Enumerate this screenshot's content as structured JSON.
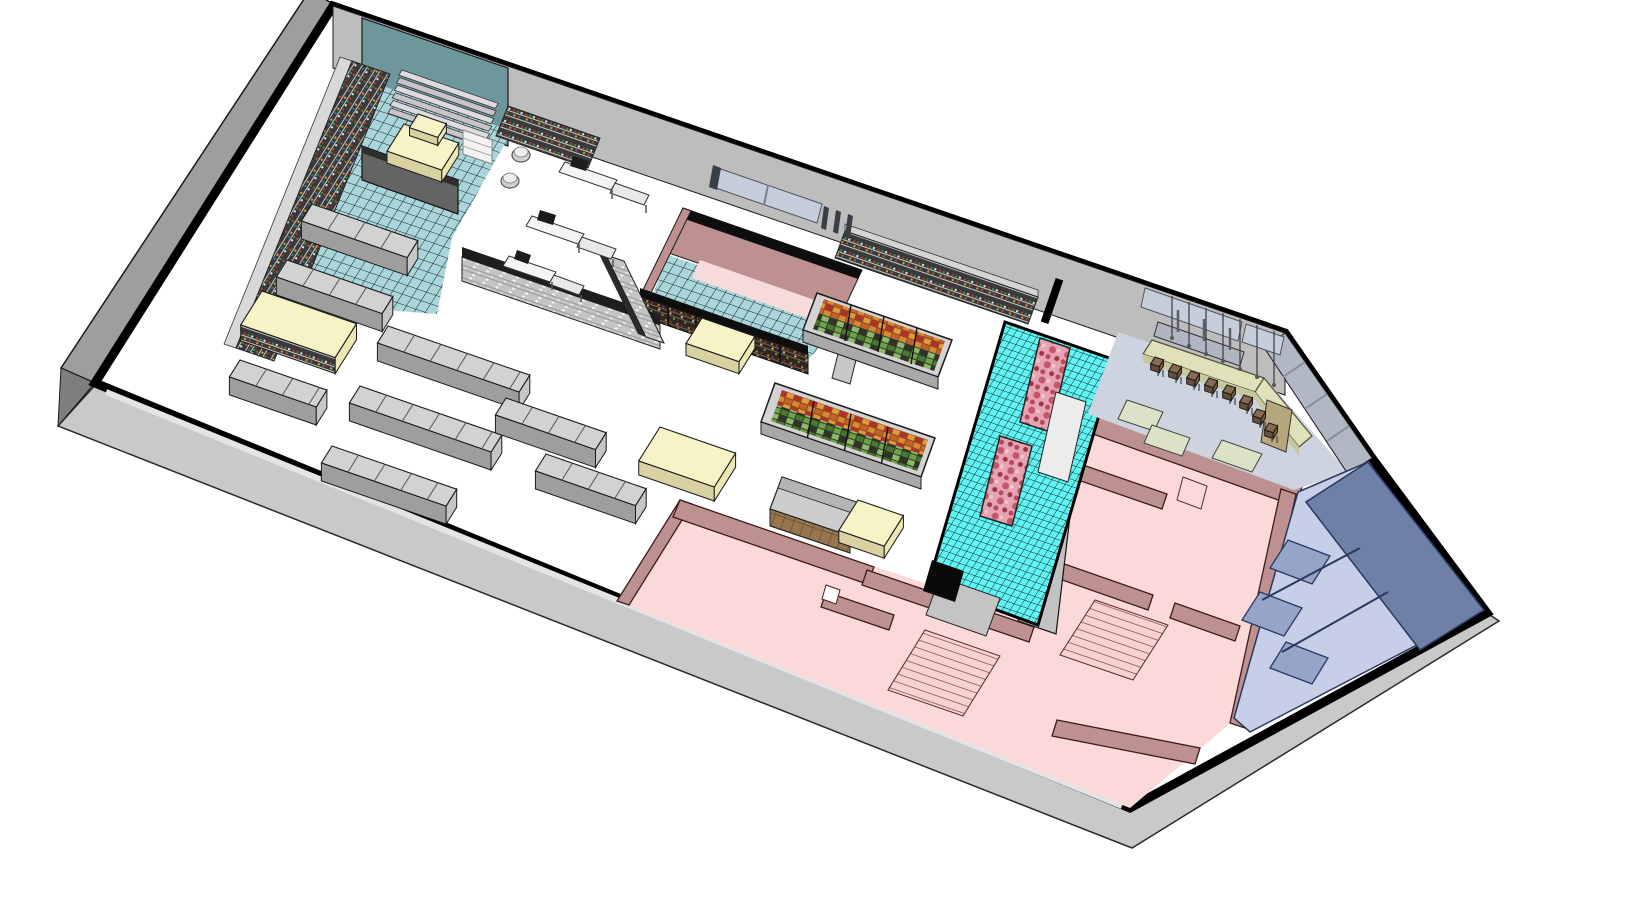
{
  "scene": {
    "kind": "isometric-3d-floorplan-render",
    "subject": "supermarket interior cutaway: sales floor with shelving aisles, checkouts, wine room, produce cases, butchery, cafe-bar, pink back-of-house rooms and blue storage room",
    "visible_text": "",
    "canvas": {
      "width": 1632,
      "height": 903
    }
  },
  "departments": [
    {
      "id": "media-department",
      "floor": "teal checkered tile"
    },
    {
      "id": "main-sales-floor",
      "floor": "white"
    },
    {
      "id": "wine-room",
      "floor": "teal checkered tile, pink walls"
    },
    {
      "id": "butchery",
      "floor": "bright cyan tile"
    },
    {
      "id": "cafe-bar",
      "floor": "light blue-gray"
    },
    {
      "id": "back-rooms",
      "floor": "pink"
    },
    {
      "id": "storage-room",
      "floor": "lavender blue"
    }
  ],
  "palette": {
    "page-bg": "#FFFFFF",
    "apron": "#C9C9C9",
    "ext-wall": "#9E9E9E",
    "ext-wall-dark": "#7E7E7E",
    "wall-gray": "#BDBDBD",
    "wall-gray2": "#C2C2C2",
    "cafe-wall": "#B2B7C4",
    "glass": "#C5CEDA",
    "teal-wall": "#6E979C",
    "teal-tile": "#A9D6DB",
    "cyan-tile": "#5FF5F5",
    "white-floor": "#FFFFFF",
    "gondola-top": "#D2D2D2",
    "gondola-front": "#9E9E9E",
    "gondola-end": "#C6C6C6",
    "cream-top": "#F8F3C6",
    "cream-front": "#D8D2A2",
    "cream-end": "#EDE7B4",
    "shelf-dark": "#1E1E1E",
    "counter-gray": "#CDCDCD",
    "wood": "#97764F",
    "basket": "#D0D0D0",
    "board": "#646464",
    "pink-floor": "#FBD9D9",
    "pink-wall": "#BE9191",
    "pink-inner": "#F7DBDB",
    "pink-line": "#3F1A1A",
    "blue-wall": "#6F80A6",
    "blue-floor": "#C7CEE7",
    "blue-part": "#97A4C9",
    "blue-line": "#2B3760",
    "cafe-floor": "#CDD3DF",
    "bar-top": "#DFE1BA",
    "bar-front": "#C6C89E",
    "tan-block": "#B5A67C",
    "stool": "#8A6B52",
    "meat-pink": "#E6A4B2",
    "meat-red": "#C4566B",
    "meat-dark": "#9D3448",
    "produce-orange": "#D98A2E",
    "produce-rust": "#C4622A",
    "produce-red": "#B03226",
    "produce-green": "#6FA04B",
    "produce-green-dark": "#49782F",
    "soil": "#8A4A26",
    "soil-dark": "#2E3B24"
  },
  "fixtures": {
    "gondola_aisles": [
      [
        312,
        204,
        112
      ],
      [
        287,
        260,
        112
      ],
      [
        240,
        360,
        92
      ],
      [
        388,
        326,
        150
      ],
      [
        360,
        386,
        150
      ],
      [
        332,
        446,
        132
      ],
      [
        506,
        398,
        106
      ],
      [
        546,
        454,
        106
      ]
    ],
    "display_tables": [
      [
        262,
        291,
        100,
        40,
        16,
        "shelf"
      ],
      [
        660,
        427,
        80,
        40,
        14,
        ""
      ],
      [
        702,
        318,
        56,
        30,
        12,
        ""
      ],
      [
        404,
        124,
        58,
        32,
        12,
        ""
      ],
      [
        418,
        114,
        30,
        16,
        8,
        ""
      ],
      [
        858,
        500,
        48,
        36,
        12,
        ""
      ]
    ],
    "stepped_display": {
      "x": 402,
      "y": 70,
      "len": 102,
      "width": 6,
      "count": 6,
      "dx": -2.2,
      "dy": 7.6
    },
    "bar_stools": [
      [
        1160,
        362
      ],
      [
        1178,
        369
      ],
      [
        1196,
        376
      ],
      [
        1214,
        383
      ],
      [
        1232,
        390
      ],
      [
        1249,
        400
      ],
      [
        1262,
        414
      ],
      [
        1274,
        428
      ]
    ],
    "pendant_lights": [
      [
        1172,
        296,
        40
      ],
      [
        1189,
        302,
        42
      ],
      [
        1206,
        308,
        44
      ],
      [
        1223,
        313,
        46
      ],
      [
        1240,
        319,
        48
      ],
      [
        1257,
        325,
        50
      ],
      [
        1274,
        331,
        52
      ]
    ],
    "checkout_count": 3,
    "staircase_count": 2,
    "meat_display_count": 2,
    "produce_case_count": 2
  }
}
